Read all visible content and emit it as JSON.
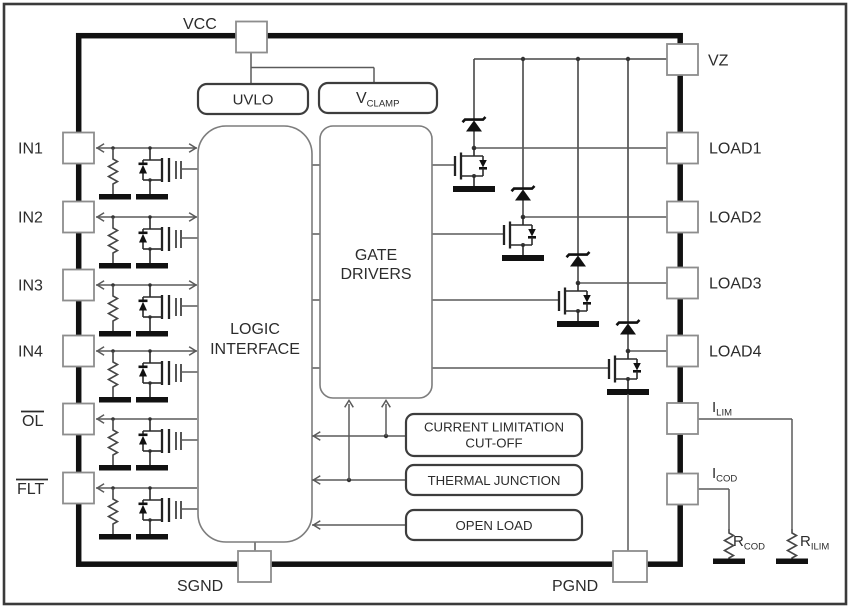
{
  "colors": {
    "background": "#ffffff",
    "frame": "#3a3a3a",
    "chip_border": "#111111",
    "wire": "#5a5a5a",
    "component": "#111111",
    "text": "#2c2c2c",
    "pin_border": "#8d8d8d",
    "block_border_strong": "#3d3d3d",
    "block_border_light": "#7d7d7d"
  },
  "pins": {
    "vcc": "VCC",
    "in1": "IN1",
    "in2": "IN2",
    "in3": "IN3",
    "in4": "IN4",
    "ol": "OL",
    "flt": "FLT",
    "sgnd": "SGND",
    "pgnd": "PGND",
    "vz": "VZ",
    "load1": "LOAD1",
    "load2": "LOAD2",
    "load3": "LOAD3",
    "load4": "LOAD4",
    "ilim": {
      "main": "I",
      "sub": "LIM"
    },
    "icod": {
      "main": "I",
      "sub": "COD"
    }
  },
  "blocks": {
    "uvlo": "UVLO",
    "vclamp": {
      "main": "V",
      "sub": "CLAMP"
    },
    "logic_interface": {
      "line1": "LOGIC",
      "line2": "INTERFACE"
    },
    "gate_drivers": {
      "line1": "GATE",
      "line2": "DRIVERS"
    },
    "current_limitation": {
      "line1": "CURRENT LIMITATION",
      "line2": "CUT-OFF"
    },
    "thermal_junction": "THERMAL JUNCTION",
    "open_load": "OPEN LOAD"
  },
  "external_components": {
    "rcod": {
      "main": "R",
      "sub": "COD"
    },
    "rilim": {
      "main": "R",
      "sub": "ILIM"
    }
  }
}
